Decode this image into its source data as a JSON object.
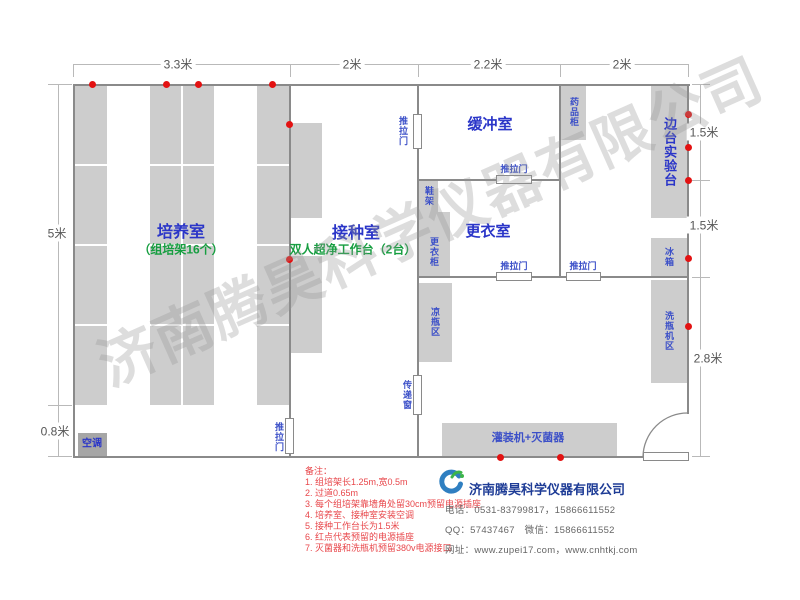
{
  "watermark": {
    "text": "济南腾昊科学仪器有限公司"
  },
  "palette": {
    "wall": "#8a8a8a",
    "dimline": "#b9b9b9",
    "block": "#cdcdcd",
    "block_dark": "#a6a6a6",
    "room_blue": "#2a35c8",
    "green": "#169e40",
    "eq_blue": "#3c50c8",
    "outlet_red": "#e31212",
    "note_red": "#e8474b",
    "dim_text": "#555555",
    "company_navy": "#1e3c96",
    "contact_gray": "#666666"
  },
  "plan": {
    "walls": [
      {
        "n": "wall-top",
        "x": 73,
        "y": 84,
        "w": 617,
        "h": 2
      },
      {
        "n": "wall-bottom",
        "x": 73,
        "y": 456,
        "w": 572,
        "h": 2
      },
      {
        "n": "wall-left",
        "x": 73,
        "y": 84,
        "w": 2,
        "h": 374
      },
      {
        "n": "wall-right",
        "x": 687,
        "y": 84,
        "w": 2,
        "h": 330
      },
      {
        "n": "wall-culture-inoculation-upper",
        "x": 289,
        "y": 84,
        "w": 2,
        "h": 336
      },
      {
        "n": "wall-culture-inoculation-stub",
        "x": 289,
        "y": 452,
        "w": 2,
        "h": 6
      },
      {
        "n": "wall-inoculation-east-1",
        "x": 417,
        "y": 84,
        "w": 2,
        "h": 31
      },
      {
        "n": "wall-inoculation-east-2",
        "x": 417,
        "y": 148,
        "w": 2,
        "h": 229
      },
      {
        "n": "wall-inoculation-east-3",
        "x": 417,
        "y": 413,
        "w": 2,
        "h": 45
      },
      {
        "n": "wall-buffer-east",
        "x": 559,
        "y": 84,
        "w": 2,
        "h": 194
      },
      {
        "n": "wall-buffer-change-1",
        "x": 418,
        "y": 179,
        "w": 79,
        "h": 2
      },
      {
        "n": "wall-buffer-change-2",
        "x": 531,
        "y": 179,
        "w": 29,
        "h": 2
      },
      {
        "n": "wall-change-south-1",
        "x": 418,
        "y": 276,
        "w": 79,
        "h": 2
      },
      {
        "n": "wall-change-south-2",
        "x": 531,
        "y": 276,
        "w": 36,
        "h": 2
      },
      {
        "n": "wall-change-south-3",
        "x": 600,
        "y": 276,
        "w": 88,
        "h": 2
      }
    ],
    "dim_lines": [
      {
        "n": "dim-line-top",
        "x": 73,
        "y": 64,
        "w": 615,
        "h": 1
      },
      {
        "n": "dim-tick",
        "x": 73,
        "y": 64,
        "w": 1,
        "h": 13
      },
      {
        "n": "dim-tick",
        "x": 290,
        "y": 64,
        "w": 1,
        "h": 13
      },
      {
        "n": "dim-tick",
        "x": 418,
        "y": 64,
        "w": 1,
        "h": 13
      },
      {
        "n": "dim-tick",
        "x": 560,
        "y": 64,
        "w": 1,
        "h": 13
      },
      {
        "n": "dim-tick",
        "x": 688,
        "y": 64,
        "w": 1,
        "h": 13
      },
      {
        "n": "dim-line-left",
        "x": 58,
        "y": 84,
        "w": 1,
        "h": 373
      },
      {
        "n": "dim-tick",
        "x": 48,
        "y": 84,
        "w": 24,
        "h": 1
      },
      {
        "n": "dim-tick",
        "x": 48,
        "y": 405,
        "w": 24,
        "h": 1
      },
      {
        "n": "dim-tick",
        "x": 48,
        "y": 456,
        "w": 24,
        "h": 1
      },
      {
        "n": "dim-line-right",
        "x": 700,
        "y": 84,
        "w": 1,
        "h": 373
      },
      {
        "n": "dim-tick",
        "x": 692,
        "y": 84,
        "w": 18,
        "h": 1
      },
      {
        "n": "dim-tick",
        "x": 692,
        "y": 180,
        "w": 18,
        "h": 1
      },
      {
        "n": "dim-tick",
        "x": 692,
        "y": 277,
        "w": 18,
        "h": 1
      },
      {
        "n": "dim-tick",
        "x": 692,
        "y": 456,
        "w": 18,
        "h": 1
      }
    ],
    "dim_labels": [
      {
        "t": "3.3米",
        "x": 178,
        "y": 64
      },
      {
        "t": "2米",
        "x": 352,
        "y": 64
      },
      {
        "t": "2.2米",
        "x": 488,
        "y": 64
      },
      {
        "t": "2米",
        "x": 622,
        "y": 64
      },
      {
        "t": "5米",
        "x": 57,
        "y": 233
      },
      {
        "t": "0.8米",
        "x": 55,
        "y": 431
      },
      {
        "t": "1.5米",
        "x": 704,
        "y": 132
      },
      {
        "t": "1.5米",
        "x": 704,
        "y": 225
      },
      {
        "t": "2.8米",
        "x": 708,
        "y": 358
      }
    ],
    "blocks": [
      {
        "n": "rack-column-west",
        "x": 75,
        "y": 85,
        "w": 32,
        "h": 320
      },
      {
        "n": "rack-column-middle",
        "x": 150,
        "y": 85,
        "w": 64,
        "h": 320
      },
      {
        "n": "rack-column-east",
        "x": 257,
        "y": 85,
        "w": 33,
        "h": 320
      },
      {
        "n": "clean-bench-1",
        "x": 291,
        "y": 123,
        "w": 31,
        "h": 95
      },
      {
        "n": "clean-bench-2",
        "x": 291,
        "y": 256,
        "w": 31,
        "h": 97
      },
      {
        "n": "shoe-rack-block",
        "x": 419,
        "y": 181,
        "w": 19,
        "h": 31
      },
      {
        "n": "wardrobe-block",
        "x": 419,
        "y": 212,
        "w": 31,
        "h": 64
      },
      {
        "n": "medicine-cabinet-block",
        "x": 561,
        "y": 86,
        "w": 25,
        "h": 54
      },
      {
        "n": "side-bench-block",
        "x": 651,
        "y": 86,
        "w": 36,
        "h": 132
      },
      {
        "n": "fridge-block",
        "x": 651,
        "y": 238,
        "w": 36,
        "h": 38
      },
      {
        "n": "bottle-washer-block",
        "x": 651,
        "y": 280,
        "w": 36,
        "h": 103
      },
      {
        "n": "bottle-cooling-block",
        "x": 419,
        "y": 283,
        "w": 33,
        "h": 79
      },
      {
        "n": "filling-sterilizer-block",
        "x": 442,
        "y": 423,
        "w": 175,
        "h": 33
      },
      {
        "n": "air-conditioner-block",
        "x": 78,
        "y": 433,
        "w": 29,
        "h": 23,
        "dark": true
      }
    ],
    "white_lines": [
      {
        "x": 75,
        "y": 164,
        "w": 32,
        "h": 2
      },
      {
        "x": 75,
        "y": 244,
        "w": 32,
        "h": 2
      },
      {
        "x": 75,
        "y": 324,
        "w": 32,
        "h": 2
      },
      {
        "x": 150,
        "y": 164,
        "w": 64,
        "h": 2
      },
      {
        "x": 150,
        "y": 244,
        "w": 64,
        "h": 2
      },
      {
        "x": 150,
        "y": 324,
        "w": 64,
        "h": 2
      },
      {
        "x": 181,
        "y": 85,
        "w": 2,
        "h": 320
      },
      {
        "x": 257,
        "y": 164,
        "w": 33,
        "h": 2
      },
      {
        "x": 257,
        "y": 244,
        "w": 33,
        "h": 2
      },
      {
        "x": 257,
        "y": 324,
        "w": 33,
        "h": 2
      }
    ],
    "doors": [
      {
        "n": "sliding-door-inoculation-buffer",
        "x": 413,
        "y": 114,
        "w": 9,
        "h": 35
      },
      {
        "n": "sliding-door-buffer-change",
        "x": 496,
        "y": 175,
        "w": 36,
        "h": 9
      },
      {
        "n": "sliding-door-change-south",
        "x": 496,
        "y": 272,
        "w": 36,
        "h": 9
      },
      {
        "n": "sliding-door-east-south",
        "x": 566,
        "y": 272,
        "w": 35,
        "h": 9
      },
      {
        "n": "sliding-door-culture-inoculation",
        "x": 285,
        "y": 418,
        "w": 9,
        "h": 36
      },
      {
        "n": "pass-window",
        "x": 413,
        "y": 375,
        "w": 9,
        "h": 40
      },
      {
        "n": "entry-door-leaf",
        "x": 643,
        "y": 452,
        "w": 46,
        "h": 9
      }
    ],
    "entry_arc": {
      "path": "M 688 413 A 44.5 44.5 0 0 0 643 457"
    },
    "outlet_dots": [
      [
        92,
        84
      ],
      [
        166,
        84
      ],
      [
        198,
        84
      ],
      [
        272,
        84
      ],
      [
        289,
        124
      ],
      [
        289,
        259
      ],
      [
        688,
        114
      ],
      [
        688,
        147
      ],
      [
        688,
        180
      ],
      [
        688,
        258
      ],
      [
        688,
        326
      ],
      [
        500,
        457
      ],
      [
        560,
        457
      ]
    ],
    "labels": [
      {
        "n": "room-label-culture",
        "t": "培养室",
        "x": 181,
        "y": 233,
        "s": 16,
        "c": "room_blue",
        "b": true
      },
      {
        "n": "room-sublabel-culture",
        "t": "（组培架16个）",
        "x": 181,
        "y": 250,
        "s": 12,
        "c": "green",
        "b": true
      },
      {
        "n": "room-label-inoculation",
        "t": "接种室",
        "x": 356,
        "y": 234,
        "s": 16,
        "c": "room_blue",
        "b": true
      },
      {
        "n": "room-sublabel-inoculation",
        "t": "双人超净工作台（2台）",
        "x": 353,
        "y": 250,
        "s": 12,
        "c": "green",
        "b": true
      },
      {
        "n": "room-label-buffer",
        "t": "缓冲室",
        "x": 490,
        "y": 125,
        "s": 15,
        "c": "room_blue",
        "b": true
      },
      {
        "n": "room-label-changing",
        "t": "更衣室",
        "x": 488,
        "y": 232,
        "s": 15,
        "c": "room_blue",
        "b": true
      },
      {
        "n": "label-side-bench",
        "t": "边台实验台",
        "x": 669,
        "y": 152,
        "s": 13,
        "c": "room_blue",
        "b": true,
        "v": true
      },
      {
        "n": "label-medicine-cabinet",
        "t": "药品柜",
        "x": 573,
        "y": 112,
        "s": 9,
        "c": "eq_blue",
        "b": true,
        "v": true
      },
      {
        "n": "label-shoe-rack",
        "t": "鞋架",
        "x": 428,
        "y": 196,
        "s": 9,
        "c": "eq_blue",
        "b": true,
        "v": true
      },
      {
        "n": "label-wardrobe",
        "t": "更衣柜",
        "x": 433,
        "y": 252,
        "s": 9,
        "c": "eq_blue",
        "b": true,
        "v": true
      },
      {
        "n": "label-bottle-cooling",
        "t": "凉瓶区",
        "x": 434,
        "y": 322,
        "s": 9,
        "c": "eq_blue",
        "b": true,
        "v": true
      },
      {
        "n": "label-fridge",
        "t": "冰箱",
        "x": 668,
        "y": 257,
        "s": 9,
        "c": "eq_blue",
        "b": true,
        "v": true
      },
      {
        "n": "label-bottle-washer",
        "t": "洗瓶机区",
        "x": 668,
        "y": 331,
        "s": 9,
        "c": "eq_blue",
        "b": true,
        "v": true
      },
      {
        "n": "label-pass-window",
        "t": "传递窗",
        "x": 406,
        "y": 395,
        "s": 9,
        "c": "eq_blue",
        "b": true,
        "v": true
      },
      {
        "n": "label-sliding-door-1",
        "t": "推拉门",
        "x": 402,
        "y": 131,
        "s": 9,
        "c": "eq_blue",
        "b": true,
        "v": true
      },
      {
        "n": "label-sliding-door-2",
        "t": "推拉门",
        "x": 514,
        "y": 170,
        "s": 9,
        "c": "eq_blue",
        "b": true
      },
      {
        "n": "label-sliding-door-3",
        "t": "推拉门",
        "x": 514,
        "y": 267,
        "s": 9,
        "c": "eq_blue",
        "b": true
      },
      {
        "n": "label-sliding-door-4",
        "t": "推拉门",
        "x": 583,
        "y": 267,
        "s": 9,
        "c": "eq_blue",
        "b": true
      },
      {
        "n": "label-sliding-door-5",
        "t": "推拉门",
        "x": 278,
        "y": 437,
        "s": 9,
        "c": "eq_blue",
        "b": true,
        "v": true
      },
      {
        "n": "label-filling-sterilizer",
        "t": "灌装机+灭菌器",
        "x": 528,
        "y": 438,
        "s": 11,
        "c": "eq_blue",
        "b": true
      },
      {
        "n": "label-air-conditioner",
        "t": "空调",
        "x": 92,
        "y": 444,
        "s": 10,
        "c": "room_blue",
        "b": true
      }
    ]
  },
  "notes": {
    "title": "备注：",
    "items": [
      "1. 组培架长1.25m,宽0.5m",
      "2. 过道0.65m",
      "3. 每个组培架靠墙角处留30cm预留电源插座",
      "4. 培养室、接种室安装空调",
      "5. 接种工作台长为1.5米",
      "6. 红点代表预留的电源插座",
      "7. 灭菌器和洗瓶机预留380v电源接口"
    ]
  },
  "company": {
    "name": "济南腾昊科学仪器有限公司",
    "phone": "电话：0531-83799817，15866611552",
    "qq_wechat": "QQ：57437467　微信：15866611552",
    "web": "网址：www.zupei17.com，www.cnhtkj.com"
  }
}
